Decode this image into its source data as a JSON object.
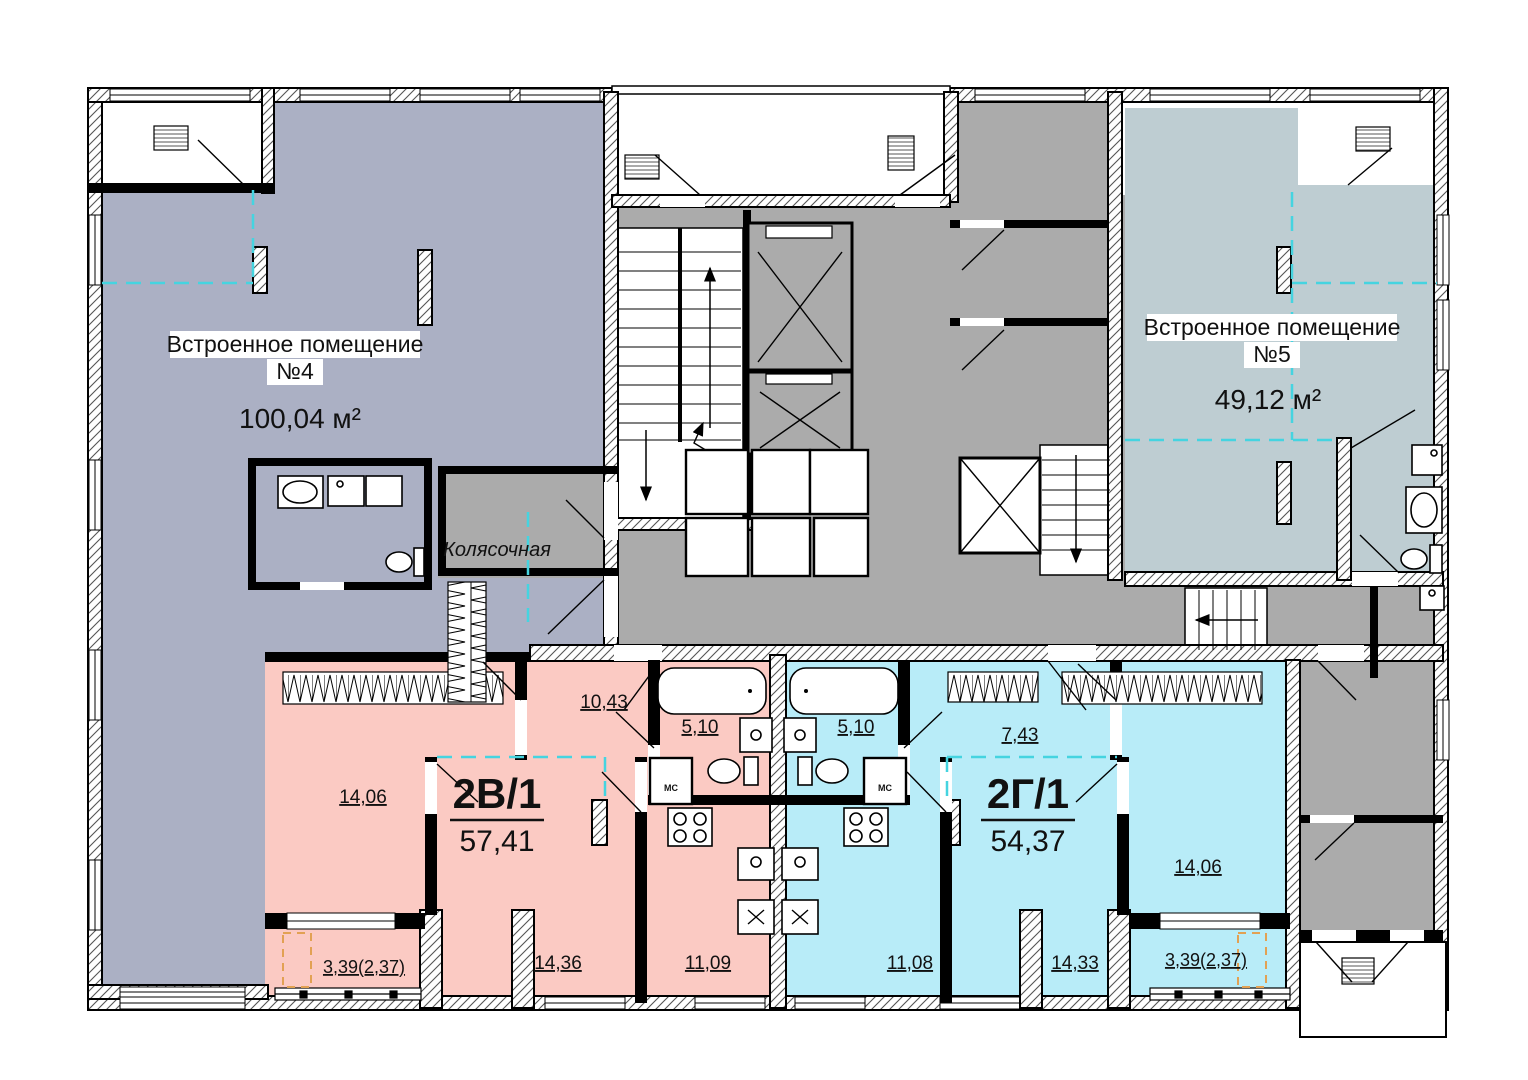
{
  "colors": {
    "unit4": "#abb0c4",
    "unit5": "#becdd2",
    "apt_left": "#fbcac3",
    "apt_right": "#b8ecf8",
    "common": "#ababab",
    "dash_cyan": "#45d4e0",
    "dash_orange": "#e2a153"
  },
  "unit4": {
    "name": "Встроенное помещение",
    "number": "№4",
    "area": "100,04 м²"
  },
  "unit5": {
    "name": "Встроенное помещение",
    "number": "№5",
    "area": "49,12 м²"
  },
  "stroller_room": {
    "label": "Колясочная"
  },
  "apt_left": {
    "code": "2В/1",
    "total_area": "57,41",
    "rooms": {
      "bedroom": "14,06",
      "hall": "10,43",
      "bathroom": "5,10",
      "living": "14,36",
      "kitchen": "11,09",
      "balcony": "3,39(2,37)"
    },
    "mc": "МС"
  },
  "apt_right": {
    "code": "2Г/1",
    "total_area": "54,37",
    "rooms": {
      "bathroom": "5,10",
      "hall": "7,43",
      "bedroom": "14,06",
      "kitchen": "11,08",
      "living": "14,33",
      "balcony": "3,39(2,37)"
    },
    "mc": "МС"
  }
}
